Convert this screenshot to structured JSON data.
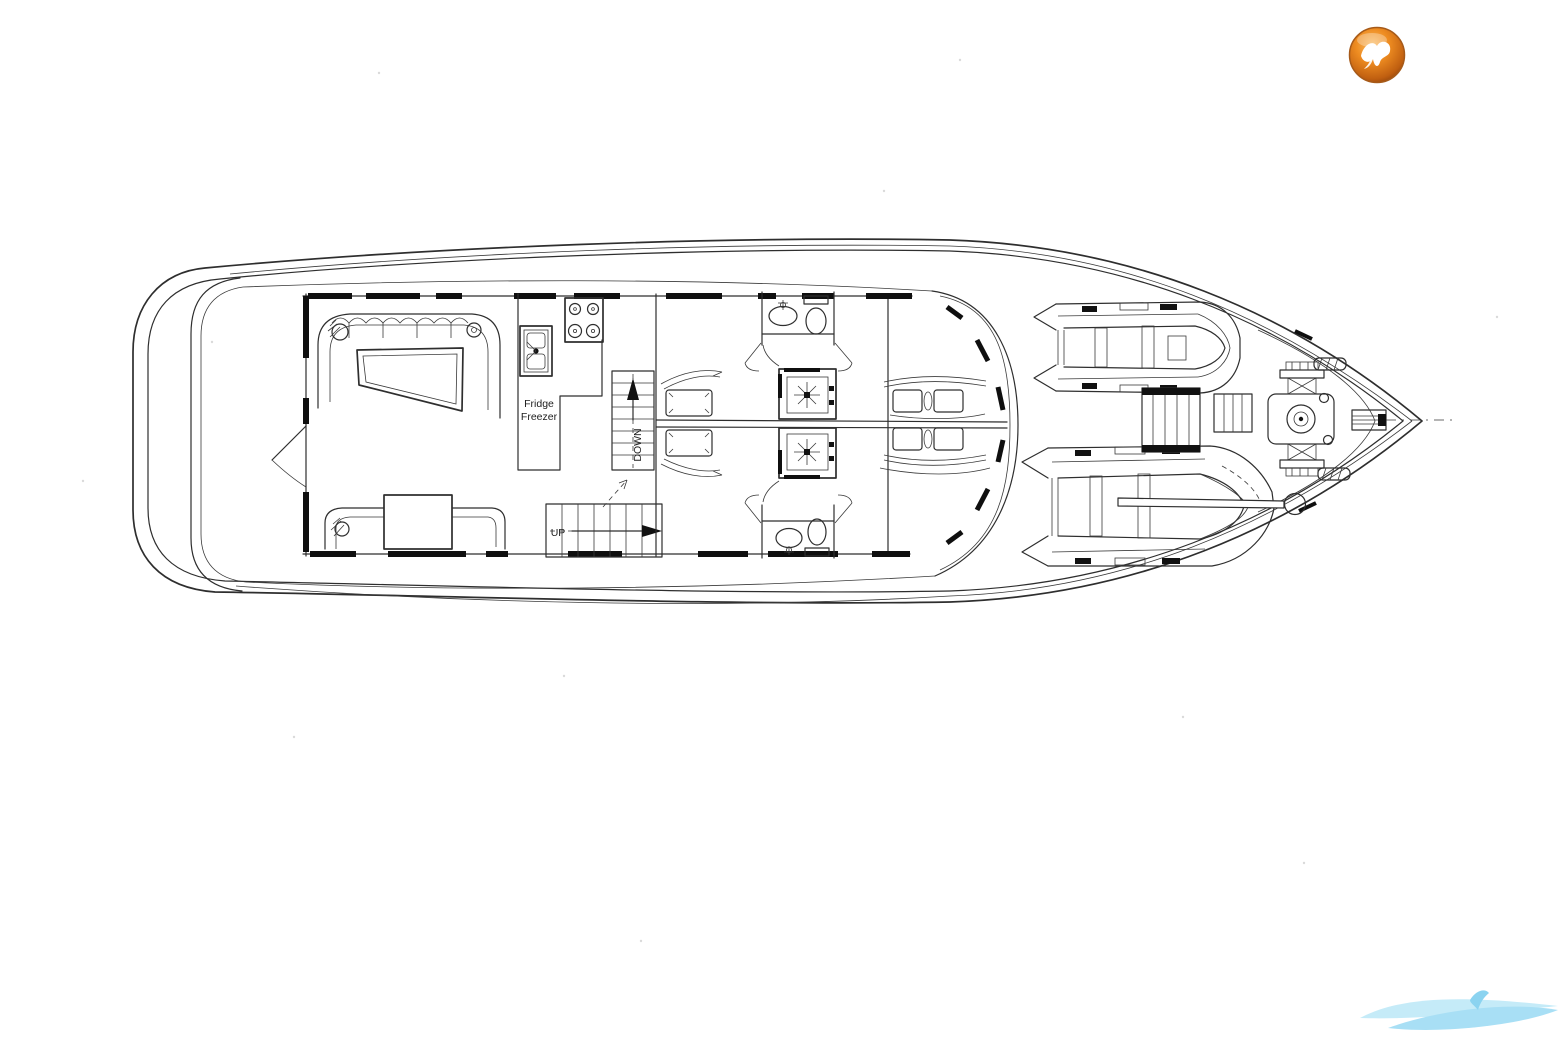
{
  "page": {
    "background_color": "#ffffff",
    "description": "motor yacht main deck floor plan drawing"
  },
  "plan": {
    "line_color": "#2e2e2e",
    "window_color": "#0f0f0f",
    "labels": {
      "fridge_line1": "Fridge",
      "fridge_line2": "Freezer",
      "down": "DOWN",
      "up": "UP"
    }
  },
  "branding": {
    "logo_icon": "orange-sphere-bird-logo",
    "logo_colors": {
      "sphere": "#e07b1a",
      "ring": "#8e420b",
      "glyph": "#ffffff"
    },
    "watermark_icon": "blue-wave-swoosh-watermark",
    "watermark_color": "#9fdcf4"
  }
}
